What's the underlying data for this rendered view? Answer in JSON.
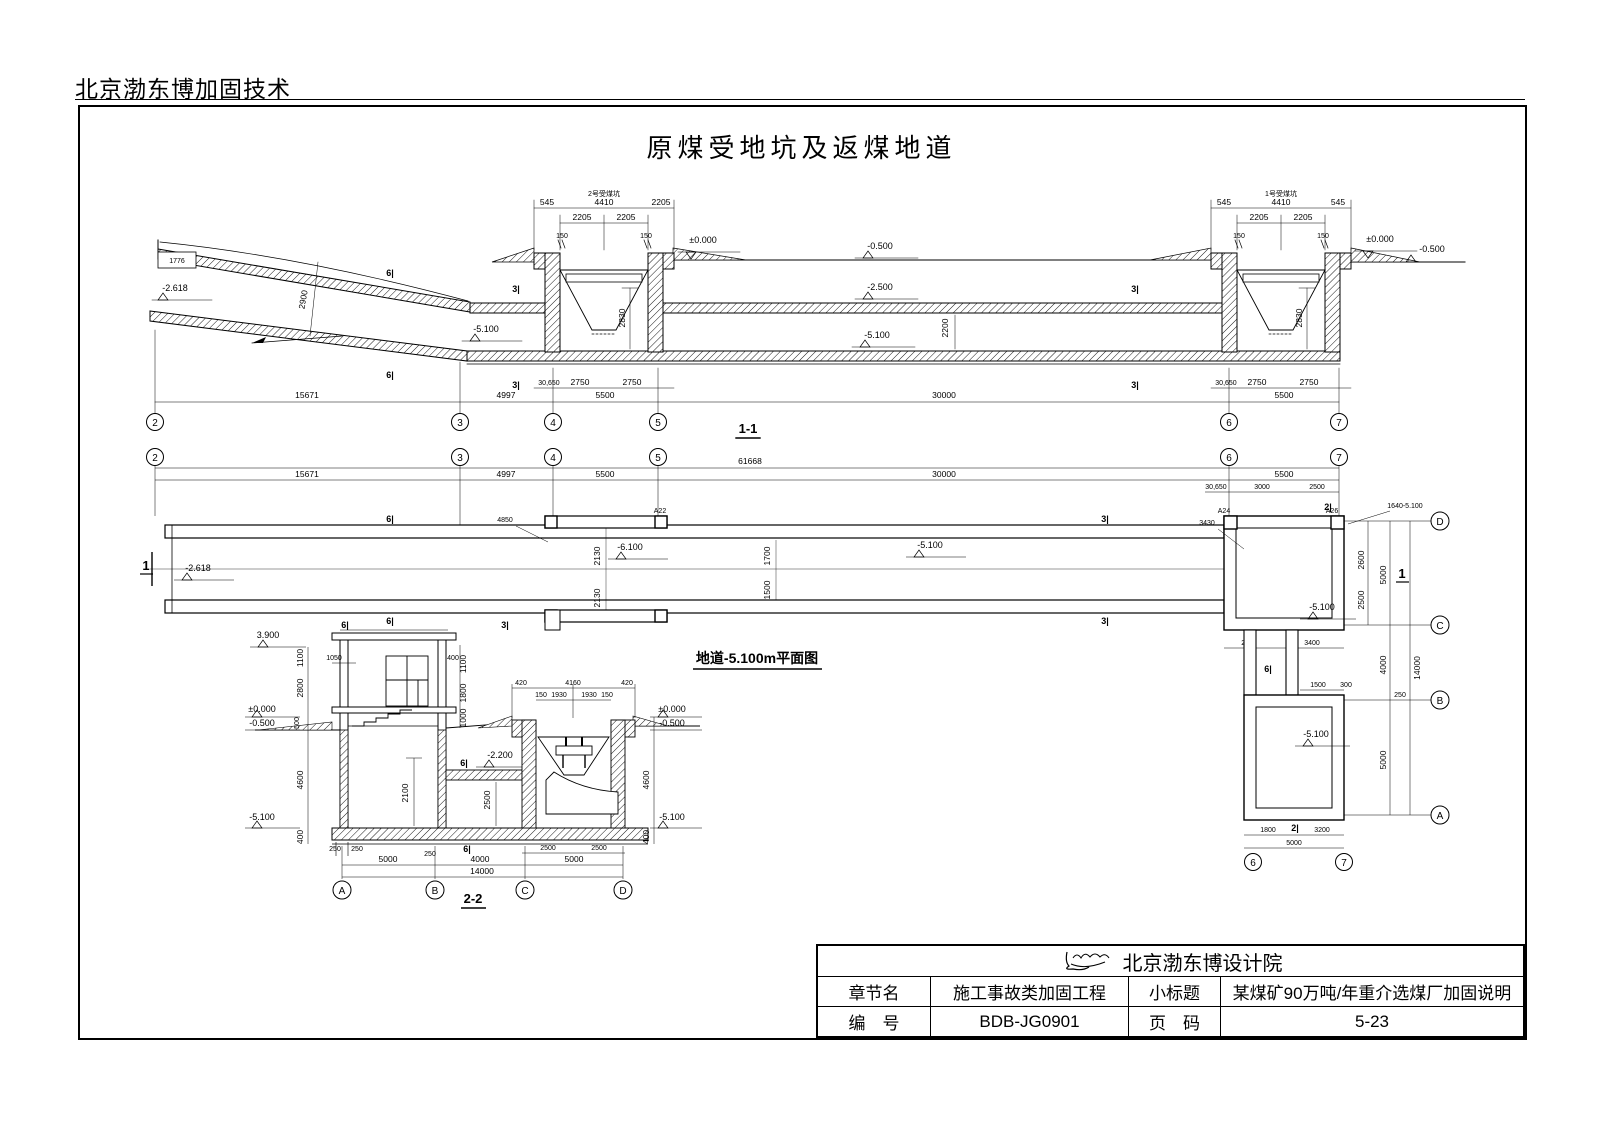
{
  "page": {
    "vendor_header": "北京渤东博加固技术",
    "drawing_title": "原煤受地坑及返煤地道"
  },
  "levels": {
    "zero": "±0.000",
    "m0500": "-0.500",
    "m2500": "-2.500",
    "m5100": "-5.100",
    "m2618": "-2.618",
    "m6100": "-6.100",
    "m2200": "-2.200",
    "p3900": "3.900"
  },
  "marks": {
    "m6": "6|",
    "m3": "3|",
    "m2": "2|"
  },
  "grids": {
    "g2": "2",
    "g3": "3",
    "g4": "4",
    "g5": "5",
    "g6": "6",
    "g7": "7",
    "gA": "A",
    "gB": "B",
    "gC": "C",
    "gD": "D"
  },
  "dims": {
    "d1776": "1776",
    "d2900": "2900",
    "d2200": "2200",
    "d2830": "2830",
    "d545": "545",
    "d4410": "4410",
    "d2205": "2205",
    "d150": "150",
    "d30650": "30,650",
    "d2750": "2750",
    "d5500": "5500",
    "d15671": "15671",
    "d4997": "4997",
    "d30000": "30000",
    "d61668": "61668",
    "d3000": "3000",
    "d2500": "2500",
    "d1700": "1700",
    "d1500": "1500",
    "d2130": "2130",
    "d2600": "2600",
    "d5000": "5000",
    "d4000": "4000",
    "d14000": "14000",
    "d2100": "2100",
    "d3400": "3400",
    "d300": "300",
    "d1800": "1800",
    "d3200": "3200",
    "d250": "250",
    "d1100": "1100",
    "d2800": "2800",
    "d500": "500",
    "d4600": "4600",
    "d400": "400",
    "d1050": "1050",
    "d1000": "1000",
    "d420": "420",
    "d4160": "4160",
    "d1930": "1930"
  },
  "s11": {
    "caption": "1-1",
    "pit_left_label": "2号受煤坑",
    "pit_right_label": "1号受煤坑"
  },
  "plan": {
    "caption": "地道-5.100m平面图",
    "cut_mark": "1",
    "col_a22": "A22",
    "col_a24": "A24",
    "col_a26": "A26",
    "leader_4850": "4850",
    "leader_3430": "3430",
    "leader_1640": "1640-5.100"
  },
  "s22": {
    "caption": "2-2"
  },
  "titleblock": {
    "org": "北京渤东博设计院",
    "row1_label": "章节名",
    "row1_value": "施工事故类加固工程",
    "row1_label2": "小标题",
    "row1_value2": "某煤矿90万吨/年重介选煤厂加固说明",
    "row2_label": "编　号",
    "row2_value": "BDB-JG0901",
    "row2_label2": "页　码",
    "row2_value2": "5-23"
  }
}
